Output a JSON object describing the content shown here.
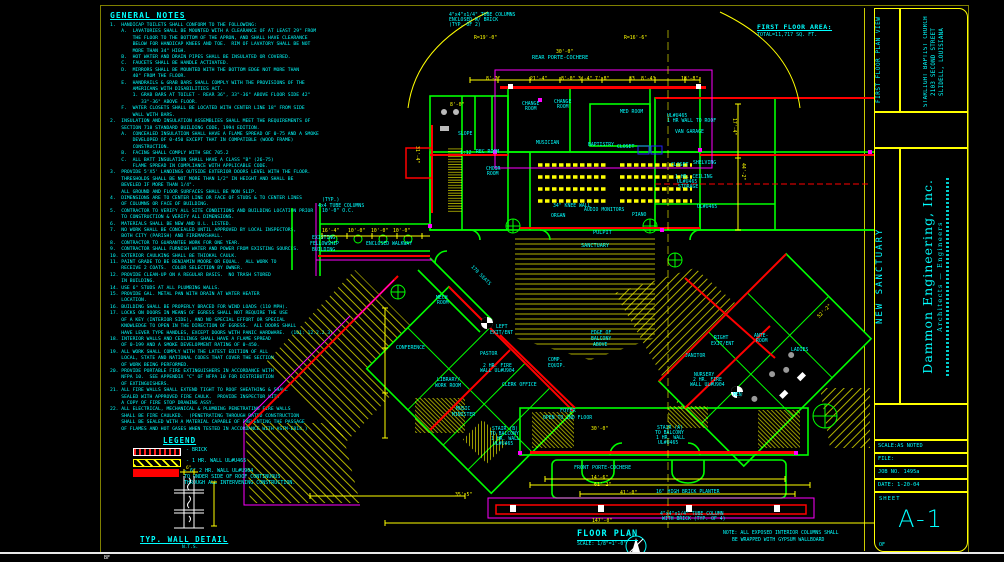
{
  "palette": {
    "wall_green": "#00ff00",
    "fire_red": "#ff0000",
    "overhang_magenta": "#ff00ff",
    "dimension_yellow": "#ffff00",
    "text_cyan": "#00ffff",
    "background": "#000000"
  },
  "sheet": {
    "bottom_code": "BF"
  },
  "general_notes": {
    "title": "GENERAL NOTES",
    "lines": [
      "1.  HANDICAP TOILETS SHALL CONFORM TO THE FOLLOWING:",
      "    A.  LAVATORIES SHALL BE MOUNTED WITH A CLEARANCE OF AT LEAST 29\" FROM",
      "        THE FLOOR TO THE BOTTOM OF THE APRON, AND SHALL HAVE CLEARANCE",
      "        BELOW FOR HANDICAP KNEES AND TOE.  RIM OF LAVATORY SHALL BE NOT",
      "        MORE THAN 34\" HIGH.",
      "    B.  HOT WATER AND DRAIN PIPES SHALL BE INSULATED OR COVERED.",
      "    C.  FAUCETS SHALL BE HANDLE ACTIVATED.",
      "    D.  MIRRORS SHALL BE MOUNTED WITH THE BOTTOM EDGE NOT MORE THAN",
      "        40\" FROM THE FLOOR.",
      "    E.  HANDRAILS & GRAB BARS SHALL COMPLY WITH THE PROVISIONS OF THE",
      "        AMERICANS WITH DISABILITIES ACT.",
      "        1. GRAB BARS AT TOILET - REAR 36\", 33\"-36\" ABOVE FLOOR SIDE 42\"",
      "           33\"-36\" ABOVE FLOOR.",
      "    F.  WATER CLOSETS SHALL BE LOCATED WITH CENTER LINE 18\" FROM SIDE",
      "        WALL WITH BARS.",
      "2.  INSULATION AND INSULATION ASSEMBLIES SHALL MEET THE REQUIREMENTS OF",
      "    SECTION 718 STANDARD BUILDING CODE, 1994 EDITION.",
      "    A.  CONCEALED INSULATION SHALL HAVE A FLAME SPREAD OF 0-75 AND A SMOKE",
      "        DEVELOPED OF 0-450 EXCEPT THAT IN COMPATIBLE (WOOD FRAME)",
      "        CONSTRUCTION.",
      "    B.  FACING SHALL COMPLY WITH SBC 705.2",
      "    C.  ALL BATT INSULATION SHALL HAVE A CLASS \"B\" (26-75)",
      "        FLAME SPREAD IN COMPLIANCE WITH APPLICABLE CODE.",
      "3.  PROVIDE 5'X5' LANDINGS OUTSIDE EXTERIOR DOORS LEVEL WITH THE FLOOR.",
      "    THRESHOLDS SHALL BE NOT MORE THAN 1/2\" IN HEIGHT AND SHALL BE",
      "    BEVELED IF MORE THAN 1/4\".",
      "    ALL GROUND AND FLOOR SURFACES SHALL BE NON SLIP.",
      "4.  DIMENSIONS ARE TO CENTER LINE OR FACE OF STUDS & TO CENTER LINES",
      "    OF COLUMNS OR FACE OF BUILDING.",
      "5.  CONTRACTOR TO VERIFY ALL SITE CONDITIONS AND BUILDING LOCATION PRIOR",
      "    TO CONSTRUCTION & VERIFY ALL DIMENSIONS.",
      "6.  MATERIALS SHALL BE NEW AND U.L. LISTED.",
      "7.  NO WORK SHALL BE CONCEALED UNTIL APPROVED BY LOCAL INSPECTORS,",
      "    BOTH CITY (PARISH) AND FIREMARSHALL.",
      "8.  CONTRACTOR TO GUARANTEE WORK FOR ONE YEAR.",
      "9.  CONTRACTOR SHALL FURNISH WATER AND POWER FROM EXISTING SOURCES.",
      "10. EXTERIOR CAULKING SHALL BE THIOKAL CAULK.",
      "11. PAINT GRADE TO BE BENJAMIN MOORE OR EQUAL.  ALL WORK TO",
      "    RECEIVE 2 COATS.  COLOR SELECTION BY OWNER.",
      "12. PROVIDE CLEAN-UP ON A REGULAR BASIS.  NO TRASH STORED",
      "    IN BUILDING.",
      "14. USE 6\" STUDS AT ALL PLUMBING WALLS.",
      "15. PROVIDE GAL. METAL PAN WITH DRAIN AT WATER HEATER",
      "    LOCATION.",
      "16. BUILDING SHALL BE PROPERLY BRACED FOR WIND LOADS (110 MPH).",
      "17. LOCKS ON DOORS IN MEANS OF EGRESS SHALL NOT REQUIRE THE USE",
      "    OF A KEY (INTERIOR SIDE), AND NO SPECIAL EFFORT OR SPECIAL",
      "    KNOWLEDGE TO OPEN IN THE DIRECTION OF EGRESS.  ALL DOORS SHALL",
      "    HAVE LEVER TYPE HANDLES, EXCEPT DOORS WITH PANIC HARDWARE.  (101: 12.2.2.3)",
      "18. INTERIOR WALLS AND CEILINGS SHALL HAVE A FLAME SPREAD",
      "    OF 0-199 AND A SMOKE DEVELOPMENT RATING OF 0-450.",
      "19. ALL WORK SHALL COMPLY WITH THE LATEST EDITION OF ALL",
      "    LOCAL, STATE AND NATIONAL CODES THAT COVER THE SECTION",
      "    OF WORK BEING PERFORMED.",
      "20. PROVIDE PORTABLE FIRE EXTINGUISHERS IN ACCORDANCE WITH",
      "    NFPA 10.  SEE APPENDIX \"C\" OF NFPA 10 FOR DISTRIBUTION",
      "    OF EXTINGUISHERS.",
      "21. ALL FIRE WALLS SHALL EXTEND TIGHT TO ROOF SHEATHING & SHALL",
      "    SEALED WITH APPROVED FIRE CAULK.  PROVIDE INSPECTOR WITH",
      "    A COPY OF FIRE STOP DRAWING ASSY.",
      "22. ALL ELECTRICAL, MECHANICAL & PLUMBING PENETRATING FIRE WALLS",
      "    SHALL BE FIRE CAULKED.  (PENETRATING THROUGH RATED CONSTRUCTION",
      "    SHALL BE SEALED WITH A MATERIAL CAPABLE OF PREVENTING THE PASSAGE",
      "    OF FLAMES AND HOT GASES WHEN TESTED IN ACCORDANCE WITH ASTM-E814.)"
    ]
  },
  "legend": {
    "title": "LEGEND",
    "items": [
      {
        "label": "-  BRICK"
      },
      {
        "label": "-  1 HR. WALL UL#U465"
      },
      {
        "label": "-  6\" 2 HR. WALL UL#U904\nTO UNDER SIDE OF ROOF CONTINUOUS\nTHROUGH ALL INTERVENING CONSTRUCTION."
      }
    ]
  },
  "wall_detail": {
    "title": "TYP. WALL DETAIL",
    "scale": "N.T.S.",
    "dim_top": "6\""
  },
  "floor_area": {
    "title": "FIRST FLOOR AREA:",
    "total": "TOTAL=11,717 SQ. FT."
  },
  "plan_title": {
    "name": "FLOOR PLAN",
    "scale": "SCALE: 1/8\"=1'-0\"",
    "note_line1": "NOTE:  ALL EXPOSED INTERIOR COLUMNS SHALL",
    "note_line2": "BE WRAPPED WITH GYPSUM WALLBOARD"
  },
  "title_block": {
    "plan_view": "FIRST FLOOR PLAN VIEW",
    "client": "STARLIGHT BAPTIST CHURCH   2103 SECOND STREET   SLIDELL, LOUISIANA",
    "project": "NEW SANCTUARY",
    "firm_name": "Dammon Engineering, Inc.",
    "firm_sub": "Architects — Engineers",
    "scale": "SCALE:AS NOTED",
    "file": "FILE:",
    "job": "JOB NO. 1495a",
    "date": "DATE: 1-20-04",
    "sheet_label": "SHEET",
    "sheet_no": "A-1",
    "of": "OF"
  },
  "plan_labels": [
    {
      "t": "4\"x4\"x1/4\" TUBE COLUMNS",
      "x": 449,
      "y": 13
    },
    {
      "t": "ENCLOSED W/ BRICK",
      "x": 449,
      "y": 18
    },
    {
      "t": "(TYP. OF 2)",
      "x": 449,
      "y": 23
    },
    {
      "t": "R=19'-0\"",
      "x": 474,
      "y": 36,
      "c": "#ffff00"
    },
    {
      "t": "R=16'-6\"",
      "x": 624,
      "y": 36,
      "c": "#ffff00"
    },
    {
      "t": "30'-0\"",
      "x": 556,
      "y": 50,
      "c": "#ffff00"
    },
    {
      "t": "REAR PORTE-COCHERE",
      "x": 532,
      "y": 56,
      "s": 5.2
    },
    {
      "t": "8'-7\"",
      "x": 486,
      "y": 77,
      "c": "#ffff00"
    },
    {
      "t": "21'-4\"",
      "x": 530,
      "y": 77,
      "c": "#ffff00"
    },
    {
      "t": "8'-0\"",
      "x": 561,
      "y": 77,
      "c": "#ffff00"
    },
    {
      "t": "3'-4\"",
      "x": 578,
      "y": 77,
      "c": "#ffff00"
    },
    {
      "t": "7'-8\"",
      "x": 595,
      "y": 77,
      "c": "#ffff00"
    },
    {
      "t": "33",
      "x": 629,
      "y": 77,
      "c": "#ffff00"
    },
    {
      "t": "8'-4\"",
      "x": 641,
      "y": 77,
      "c": "#ffff00"
    },
    {
      "t": "18'-8\"",
      "x": 681,
      "y": 77,
      "c": "#ffff00"
    },
    {
      "t": "8'-0\"",
      "x": 450,
      "y": 103,
      "c": "#ffff00"
    },
    {
      "t": "CHANGE",
      "x": 522,
      "y": 102
    },
    {
      "t": "ROOM",
      "x": 525,
      "y": 107
    },
    {
      "t": "CHANGE",
      "x": 554,
      "y": 100
    },
    {
      "t": "ROOM",
      "x": 557,
      "y": 105
    },
    {
      "t": "MED ROOM",
      "x": 620,
      "y": 110
    },
    {
      "t": "UL#U465",
      "x": 667,
      "y": 114
    },
    {
      "t": "1 HR WALL TO ROOF",
      "x": 667,
      "y": 119
    },
    {
      "t": "VAN GARAGE",
      "x": 675,
      "y": 130
    },
    {
      "t": "MUSICIAN",
      "x": 536,
      "y": 141
    },
    {
      "t": "BAPTISTRY",
      "x": 588,
      "y": 143
    },
    {
      "t": "CLOSET",
      "x": 617,
      "y": 145
    },
    {
      "t": "SLOPE",
      "x": 458,
      "y": 132
    },
    {
      "t": "1:12",
      "x": 460,
      "y": 151
    },
    {
      "t": "REC ROOM",
      "x": 476,
      "y": 150
    },
    {
      "t": "CHOIR",
      "x": 486,
      "y": 167
    },
    {
      "t": "ROOM",
      "x": 487,
      "y": 172
    },
    {
      "t": "CLOSET",
      "x": 671,
      "y": 163
    },
    {
      "t": "SHELVING",
      "x": 693,
      "y": 161
    },
    {
      "t": "1 HR. CEILING",
      "x": 675,
      "y": 175
    },
    {
      "t": "UL#U465",
      "x": 677,
      "y": 180
    },
    {
      "t": "STORAGE",
      "x": 678,
      "y": 185
    },
    {
      "t": "17'-4\"",
      "x": 736,
      "y": 118,
      "c": "#ffff00",
      "r": 90
    },
    {
      "t": "44'-2\"",
      "x": 745,
      "y": 163,
      "c": "#ffff00",
      "r": 90
    },
    {
      "t": "31'-4\"",
      "x": 419,
      "y": 146,
      "c": "#ffff00",
      "r": 90
    },
    {
      "t": "(TYP.)",
      "x": 322,
      "y": 198
    },
    {
      "t": "4x4 TUBE COLUMNS",
      "x": 318,
      "y": 204
    },
    {
      "t": "10'-0\" O.C.",
      "x": 322,
      "y": 209
    },
    {
      "t": "16'-4\"",
      "x": 322,
      "y": 229,
      "c": "#ffff00"
    },
    {
      "t": "10'-0\"",
      "x": 348,
      "y": 229,
      "c": "#ffff00"
    },
    {
      "t": "10'-0\"",
      "x": 371,
      "y": 229,
      "c": "#ffff00"
    },
    {
      "t": "10'-0\"",
      "x": 393,
      "y": 229,
      "c": "#ffff00"
    },
    {
      "t": "EXISTING",
      "x": 312,
      "y": 236
    },
    {
      "t": "FELLOWSHIP",
      "x": 310,
      "y": 242
    },
    {
      "t": "BUILDING",
      "x": 312,
      "y": 248
    },
    {
      "t": "ENCLOSED WALKWAY",
      "x": 366,
      "y": 242
    },
    {
      "t": "34\" KNEE WALL",
      "x": 553,
      "y": 204
    },
    {
      "t": "AUDIO MONITORS",
      "x": 584,
      "y": 208
    },
    {
      "t": "ORGAN",
      "x": 551,
      "y": 214
    },
    {
      "t": "PIANO",
      "x": 632,
      "y": 213
    },
    {
      "t": "UL#U465",
      "x": 697,
      "y": 205
    },
    {
      "t": "PULPIT",
      "x": 593,
      "y": 231,
      "s": 5.2
    },
    {
      "t": "SANCTUARY",
      "x": 581,
      "y": 244,
      "s": 5.2
    },
    {
      "t": "170 SEATS",
      "x": 473,
      "y": 265,
      "r": 45
    },
    {
      "t": "MECH",
      "x": 436,
      "y": 296
    },
    {
      "t": "ROOM",
      "x": 437,
      "y": 301
    },
    {
      "t": "CONFERENCE",
      "x": 396,
      "y": 346
    },
    {
      "t": "PASTOR",
      "x": 480,
      "y": 352
    },
    {
      "t": "2 HR. FIRE",
      "x": 483,
      "y": 364
    },
    {
      "t": "WALL UL#U904",
      "x": 480,
      "y": 369
    },
    {
      "t": "LIBRARY/",
      "x": 437,
      "y": 378
    },
    {
      "t": "WORK ROOM",
      "x": 435,
      "y": 384
    },
    {
      "t": "CLERK OFFICE",
      "x": 502,
      "y": 383
    },
    {
      "t": "MUSIC",
      "x": 456,
      "y": 407
    },
    {
      "t": "MINISTER",
      "x": 452,
      "y": 413
    },
    {
      "t": "LEFT",
      "x": 496,
      "y": 325
    },
    {
      "t": "EXIT/ENT",
      "x": 490,
      "y": 331
    },
    {
      "t": "COMP.",
      "x": 548,
      "y": 358
    },
    {
      "t": "EQUIP.",
      "x": 548,
      "y": 364
    },
    {
      "t": "EDGE OF",
      "x": 591,
      "y": 331
    },
    {
      "t": "BALCONY",
      "x": 591,
      "y": 337
    },
    {
      "t": "ABOVE",
      "x": 593,
      "y": 343
    },
    {
      "t": "FOYER",
      "x": 560,
      "y": 409,
      "s": 5.2
    },
    {
      "t": "OPEN TO 2ND FLOOR",
      "x": 543,
      "y": 416
    },
    {
      "t": "STAIR (B)",
      "x": 492,
      "y": 427
    },
    {
      "t": "TO BALCONY",
      "x": 490,
      "y": 432
    },
    {
      "t": "1 HR. WALL",
      "x": 491,
      "y": 437
    },
    {
      "t": "UL#U465",
      "x": 493,
      "y": 442
    },
    {
      "t": "STAIR (A)",
      "x": 657,
      "y": 426
    },
    {
      "t": "TO BALCONY",
      "x": 655,
      "y": 431
    },
    {
      "t": "1 HR. WALL",
      "x": 656,
      "y": 436
    },
    {
      "t": "UL#U465",
      "x": 658,
      "y": 441
    },
    {
      "t": "FRONT PORTE-COCHERE",
      "x": 574,
      "y": 466,
      "s": 5
    },
    {
      "t": "30'-0\"",
      "x": 591,
      "y": 427,
      "c": "#ffff00"
    },
    {
      "t": "14'-6\"",
      "x": 591,
      "y": 476,
      "c": "#ffff00"
    },
    {
      "t": "61'-2\"",
      "x": 594,
      "y": 483,
      "c": "#ffff00"
    },
    {
      "t": "41'-0\"",
      "x": 620,
      "y": 491,
      "c": "#ffff00"
    },
    {
      "t": "35'-5\"",
      "x": 455,
      "y": 493,
      "c": "#ffff00"
    },
    {
      "t": "147'-0\"",
      "x": 592,
      "y": 519,
      "c": "#ffff00"
    },
    {
      "t": "16\" HIGH BRICK PLANTER",
      "x": 656,
      "y": 490
    },
    {
      "t": "4\"x4\"x1/4\" TUBE COLUMN",
      "x": 660,
      "y": 512
    },
    {
      "t": "WITH BRICK (TYP. OF 4)",
      "x": 662,
      "y": 517
    },
    {
      "t": "RIGHT",
      "x": 714,
      "y": 336
    },
    {
      "t": "EXIT/ENT",
      "x": 711,
      "y": 342
    },
    {
      "t": "ANTE-",
      "x": 754,
      "y": 334
    },
    {
      "t": "ROOM",
      "x": 756,
      "y": 339
    },
    {
      "t": "LADIES",
      "x": 791,
      "y": 348
    },
    {
      "t": "JANITOR",
      "x": 685,
      "y": 354
    },
    {
      "t": "NURSERY",
      "x": 694,
      "y": 373
    },
    {
      "t": "2 HR. FIRE",
      "x": 693,
      "y": 378
    },
    {
      "t": "WALL UL#U904",
      "x": 690,
      "y": 383
    },
    {
      "t": "MEN",
      "x": 733,
      "y": 393
    },
    {
      "t": "52'-2\"",
      "x": 817,
      "y": 316,
      "c": "#ffff00",
      "r": -45
    }
  ]
}
